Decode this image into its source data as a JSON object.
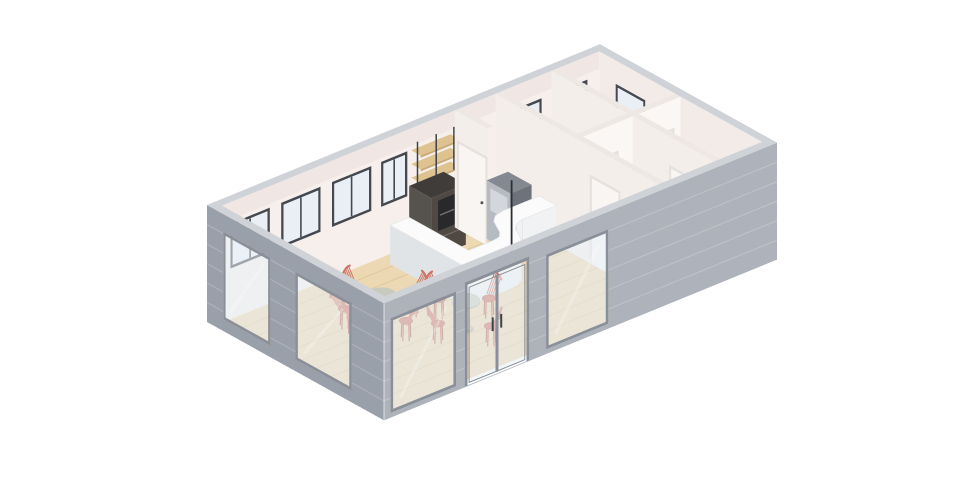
{
  "scene": {
    "title": "3D isometric cutaway floor plan render of a small cafe building",
    "background": "#ffffff",
    "projection": {
      "origin": [
        207,
        322
      ],
      "ax": [
        32.75,
        -13.4
      ],
      "ay": [
        29.5,
        16.4
      ],
      "az": 39
    },
    "building": {
      "length": 12,
      "depth": 6,
      "wall_height": 3,
      "wall_thickness": 0.24
    },
    "colors": {
      "wall_front": "#aeb3bb",
      "wall_gable": "#9aa0a9",
      "wall_top": "#cfd3d8",
      "siding": "rgba(255,255,255,0.20)",
      "edge_highlight": "rgba(255,255,255,0.55)",
      "interior_back": "#f7efeb",
      "interior_right": "#f3ebe7",
      "wall_shadow": "rgba(110,80,70,0.05)",
      "partition_x": "#f4eeeb",
      "partition_y": "#fbf7f4",
      "partition_top": "#eee8e4",
      "floor_wood": "#ecd8b2",
      "floor_seam": "#dcc397",
      "floor_pale": "#f5eeea",
      "frame_int": "#44484f",
      "glass_int": "#eaeff5",
      "frame_ext": "#8a9099",
      "glass_ext": "rgba(234,240,246,0.55)",
      "glass_sheen": "rgba(255,255,255,0.45)",
      "door": "#f8f5f3",
      "door_frame": "#e7e1dc",
      "handle": "#51565d",
      "counter_top": "#fbfbfb",
      "counter_front": "#f0f2f3",
      "counter_left": "#e1e4e7",
      "counter_edge": "#e4e6e8",
      "case_top": "#3f3c39",
      "case_side": "#56524d",
      "case_front": "#746b62",
      "case_glass": "rgba(35,32,30,0.45)",
      "machine_body": "#2e3236",
      "machine_trim": "rgba(200,206,214,0.85)",
      "shelf": "#dec28f",
      "shelf_edge": "#c9aa77",
      "rod": "#3d4147",
      "fridge_top": "#848991",
      "fridge_left": "#b6bbc1",
      "fridge_recess": "#d3d7db",
      "fridge_right": "#6e737b",
      "fridge_line": "#5a5f66",
      "table_top": "#c9cabe",
      "table_edge": "#b3b5a7",
      "pedestal": "#d0c4af",
      "pedestal_dark": "#bfb199",
      "chair": "#ce7568",
      "chair_dark": "#b35c4f",
      "pole": "#2c3034"
    },
    "exterior": {
      "siding_z": [
        0.5,
        1.0,
        1.5,
        2.0,
        2.5
      ],
      "frame_t": 0.08,
      "gable_windows": [
        {
          "y0": 0.55,
          "y1": 2.15,
          "z0": 0.3,
          "z1": 2.55
        },
        {
          "y0": 3.0,
          "y1": 4.9,
          "z0": 0.3,
          "z1": 2.55
        }
      ],
      "front_windows": [
        {
          "x0": 0.2,
          "x1": 2.2,
          "z0": 0.12,
          "z1": 2.55
        },
        {
          "x0": 4.95,
          "x1": 6.85,
          "z0": 0.12,
          "z1": 2.55
        }
      ],
      "front_door": {
        "x0": 2.55,
        "x1": 4.35,
        "z0": 0.02,
        "z1": 2.6
      }
    },
    "interior": {
      "frame_t": 0.07,
      "door_height": 2.2,
      "back_band_windows": [
        {
          "x0": 0.5,
          "x1": 1.7
        },
        {
          "x0": 2.05,
          "x1": 3.25
        },
        {
          "x0": 3.6,
          "x1": 4.8
        },
        {
          "x0": 5.1,
          "x1": 5.9
        }
      ],
      "band_window_z": {
        "z0": 1.3,
        "z1": 2.45
      },
      "room_back_windows": [
        {
          "x0": 9.0,
          "x1": 10.0,
          "z0": 1.55,
          "z1": 2.4
        },
        {
          "x0": 10.6,
          "x1": 11.4,
          "z0": 1.55,
          "z1": 2.4
        }
      ],
      "right_gable_window": {
        "y0": 0.8,
        "y1": 1.8,
        "z0": 1.55,
        "z1": 2.4
      },
      "partitions": {
        "kitchen_stub": {
          "x": 7.35,
          "y0": 0.24,
          "y1": 1.35,
          "door": {
            "y0": 0.38,
            "y1": 1.28
          }
        },
        "main": {
          "x": 8.6,
          "y0": 0.24,
          "y1": 5.76,
          "door": {
            "y0": 3.5,
            "y1": 4.4
          }
        },
        "mid": {
          "y": 3.0,
          "x0": 8.6,
          "x1": 11.76,
          "doors": [
            {
              "x0": 8.95,
              "x1": 9.8
            },
            {
              "x0": 10.7,
              "x1": 11.5
            }
          ]
        },
        "back_rooms": {
          "x": 10.3,
          "y0": 0.24,
          "y1": 3.0
        },
        "front_rooms": {
          "x": 10.3,
          "y0": 3.0,
          "y1": 5.76,
          "door": {
            "y0": 4.3,
            "y1": 5.2
          }
        }
      },
      "plank_seam_ys": [
        0.7,
        1.2,
        1.7,
        2.2,
        2.7,
        3.2,
        3.7,
        4.2,
        4.7,
        5.2
      ]
    },
    "furniture": {
      "tables": [
        {
          "x": 3.0,
          "y": 2.6,
          "chair_angles": [
            268,
            182,
            92,
            8,
            212
          ]
        },
        {
          "x": 4.3,
          "y": 4.0,
          "chair_angles": [
            266,
            180,
            90,
            350
          ]
        }
      ],
      "table_style": {
        "top_z": 0.72,
        "ring_radius": 0.85,
        "seat_z": 0.46
      },
      "counter": {
        "height": 1.0,
        "outer": [
          [
            5.05,
            0.6
          ],
          [
            5.05,
            3.2
          ],
          [
            6.35,
            3.2
          ],
          [
            6.62,
            3.18
          ],
          [
            6.85,
            3.05
          ],
          [
            7.0,
            2.82
          ],
          [
            7.12,
            2.55
          ],
          [
            7.3,
            2.38
          ],
          [
            7.55,
            2.3
          ],
          [
            8.6,
            2.3
          ]
        ],
        "inner": [
          [
            8.6,
            1.72
          ],
          [
            7.5,
            1.72
          ],
          [
            7.2,
            1.78
          ],
          [
            7.0,
            1.95
          ],
          [
            6.88,
            2.18
          ],
          [
            6.76,
            2.42
          ],
          [
            6.6,
            2.58
          ],
          [
            6.38,
            2.62
          ],
          [
            5.63,
            2.62
          ],
          [
            5.63,
            0.6
          ]
        ]
      },
      "bar_case": {
        "x0": 5.95,
        "y0": 0.25,
        "x1": 7.0,
        "y1": 1.0,
        "h": 1.55
      },
      "espresso_machine": {
        "x0": 6.2,
        "y0": 0.35,
        "x1": 6.75,
        "y1": 0.95,
        "z0": 0.6,
        "z1": 1.38
      },
      "shelves": {
        "x0": 6.0,
        "x1": 7.2,
        "y0": 0.26,
        "y1": 0.58,
        "levels": [
          1.75,
          2.1,
          2.45
        ],
        "thickness": 0.055,
        "rod_xs": [
          6.05,
          6.62,
          7.16
        ],
        "rod_z0": 1.62,
        "rod_z1": 2.72
      },
      "fridge": {
        "x0": 7.55,
        "y0": 1.1,
        "x1": 8.2,
        "y1": 1.9,
        "h": 1.5,
        "drawer_zs": [
          0.42,
          0.8,
          1.14
        ]
      },
      "pole": {
        "x": 7.5,
        "y": 2.0,
        "z1": 1.9
      }
    }
  }
}
